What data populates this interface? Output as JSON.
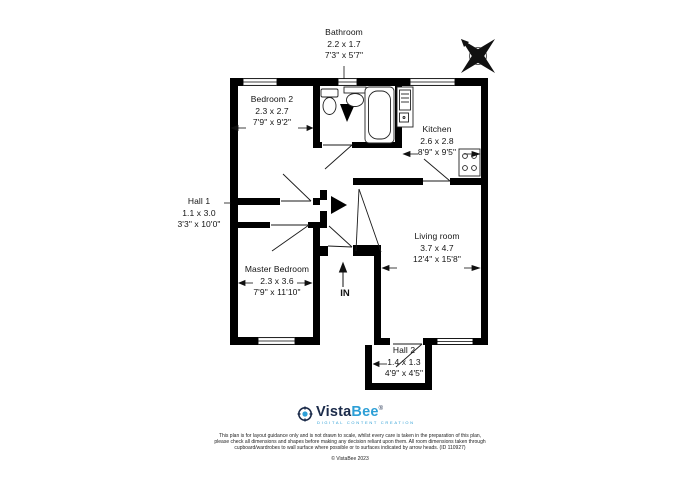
{
  "rooms": {
    "bathroom": {
      "name": "Bathroom",
      "metric": "2.2 x 1.7",
      "imperial": "7'3\" x 5'7\""
    },
    "bedroom2": {
      "name": "Bedroom 2",
      "metric": "2.3 x 2.7",
      "imperial": "7'9\" x 9'2\""
    },
    "kitchen": {
      "name": "Kitchen",
      "metric": "2.6 x 2.8",
      "imperial": "8'9\" x 9'5\""
    },
    "hall1": {
      "name": "Hall 1",
      "metric": "1.1 x 3.0",
      "imperial": "3'3\" x 10'0\""
    },
    "living_room": {
      "name": "Living room",
      "metric": "3.7 x 4.7",
      "imperial": "12'4\" x 15'8\""
    },
    "master_bedroom": {
      "name": "Master Bedroom",
      "metric": "2.3 x 3.6",
      "imperial": "7'9\" x 11'10\""
    },
    "hall2": {
      "name": "Hall 2",
      "metric": "1.4 x 1.3",
      "imperial": "4'9\" x 4'5\""
    }
  },
  "entrance": {
    "label": "IN"
  },
  "branding": {
    "brand_vista": "Vista",
    "brand_bee": "Bee",
    "trademark": "®",
    "tagline": "DIGITAL CONTENT CREATION"
  },
  "footer": {
    "disclaimer_line1": "This plan is for layout guidance only and is not drawn to scale, whilst every care is taken in the preparation of this plan,",
    "disclaimer_line2": "please check all dimensions and shapes before making any decision reliant upon them. All room dimensions taken through",
    "disclaimer_line3": "cupboard/wardrobes to wall surface where possible or to surfaces indicated by arrow heads. (ID 110927)",
    "copyright": "© VistaBee 2023"
  },
  "colors": {
    "wall": "#000000",
    "brand_navy": "#1b2b4a",
    "brand_blue": "#2d9fd6"
  }
}
